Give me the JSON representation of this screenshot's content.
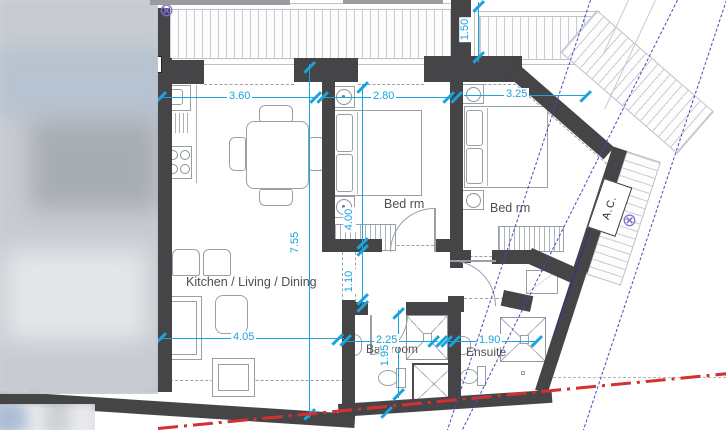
{
  "plan": {
    "labels": {
      "kitchen_living_dining": "Kitchen / Living / Dining",
      "bedroom_1": "Bed rm",
      "bedroom_2": "Bed rm",
      "bathroom": "Bathroom",
      "ensuite": "Ensuite",
      "ac_unit": "A.C."
    },
    "dimensions": {
      "kitchen_width": "3.60",
      "bedroom1_width": "2.80",
      "bedroom2_width": "3.25",
      "balcony_depth": "1.50",
      "living_length": "7.55",
      "bedroom1_length": "4.00",
      "hall_width": "1.10",
      "living_width": "4.05",
      "bathroom_width": "2.25",
      "ensuite_width": "1.90",
      "bathroom_length": "1.95"
    },
    "symbols": {
      "circled_x_marker": "⊗"
    },
    "colors": {
      "wall": "#454548",
      "dimension_cyan": "#1aa3dc",
      "boundary_red": "#d62f2f",
      "setback_blue": "#4646c6",
      "furniture_line": "#98a0a6",
      "label_text": "#4f4f4f"
    }
  }
}
